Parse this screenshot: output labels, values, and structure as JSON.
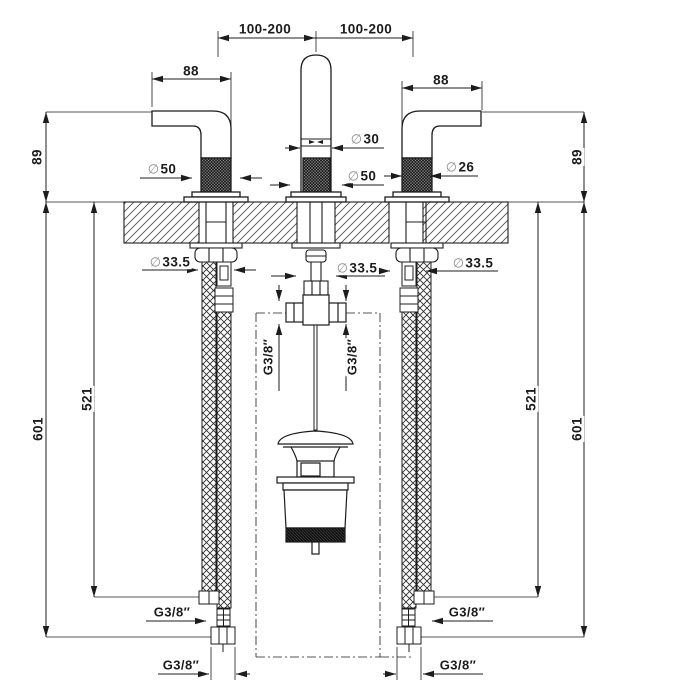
{
  "dims": {
    "span_left": "100-200",
    "span_right": "100-200",
    "handle_length_left": "88",
    "handle_length_right": "88",
    "height_above_deck_left": "89",
    "height_above_deck_right": "89",
    "hose_inner_left": "521",
    "hose_inner_right": "521",
    "hose_outer_left": "601",
    "hose_outer_right": "601"
  },
  "diameters": {
    "symbol": "∅",
    "handle_base_left": "50",
    "spout_tube": "30",
    "spout_base": "50",
    "handle_body_right": "26",
    "deck_hole_left": "33.5",
    "deck_hole_center": "33.5",
    "deck_hole_right": "33.5"
  },
  "threads": {
    "tee_port_left": "G3/8″",
    "tee_port_right": "G3/8″",
    "hose_elbow_left": "G3/8″",
    "hose_elbow_right": "G3/8″",
    "hose_end_left": "G3/8″",
    "hose_end_right": "G3/8″"
  },
  "colors": {
    "line": "#1c1c1c",
    "dim_symbol": "#8d8d8d",
    "background": "#ffffff"
  }
}
